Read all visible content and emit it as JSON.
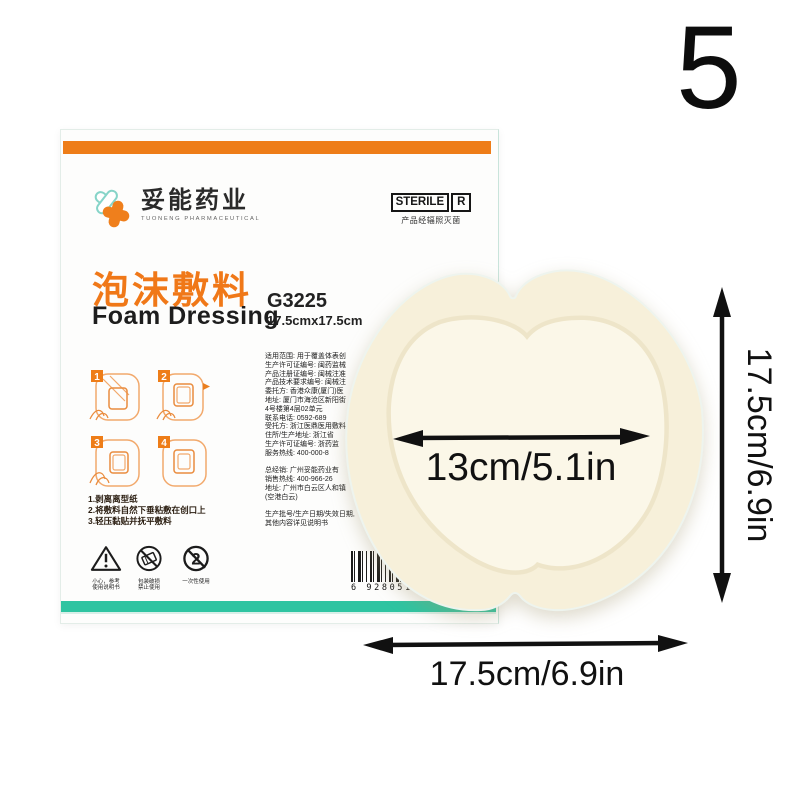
{
  "page": {
    "number": "5"
  },
  "colors": {
    "orange": "#EE7D18",
    "teal": "#2EC4A1",
    "foam_outer": "#F7F0DA",
    "foam_pad": "#FBF7E8"
  },
  "box": {
    "logo": {
      "name_cn": "妥能药业",
      "name_en": "TUONENG PHARMACEUTICAL"
    },
    "sterile": {
      "label": "STERILE",
      "r": "R",
      "caption": "产品经辐照灭菌"
    },
    "title_cn": "泡沫敷料",
    "title_en": "Foam Dressing",
    "model": "G3225",
    "size": "17.5cmx17.5cm",
    "steps": [
      "1",
      "2",
      "3",
      "4"
    ],
    "instructions": "1.剥离离型纸\n2.将敷料自然下垂粘敷在创口上\n3.轻压黏贴并抚平敷料",
    "fine_print": "适用范围: 用于覆盖体表创\n生产许可证编号: 闽药监械\n产品注册证编号: 闽械注准\n产品技术要求编号: 闽械注\n委托方: 香港众康(厦门)医\n地址: 厦门市海沧区新阳街\n4号楼第4层02单元\n联系电话: 0592-689\n受托方: 浙江医鼎医用敷料\n住所/生产地址: 浙江省\n生产许可证编号: 浙药监\n服务热线: 400-000-8\n\n总经销: 广州妥能药业有\n销售热线: 400-966-26\n地址: 广州市白云区人和镇\n(空港白云)\n\n生产批号/生产日期/失效日期,\n其他内容详见说明书",
    "warnings": [
      {
        "caption": "小心，参考\n使用说明书"
      },
      {
        "caption": "包装破损\n禁止使用"
      },
      {
        "caption": "一次性使用"
      }
    ],
    "barcode_digits": "6 928051 0"
  },
  "dimensions": {
    "inner_width": "13cm/5.1in",
    "height": "17.5cm/6.9in",
    "width": "17.5cm/6.9in"
  }
}
